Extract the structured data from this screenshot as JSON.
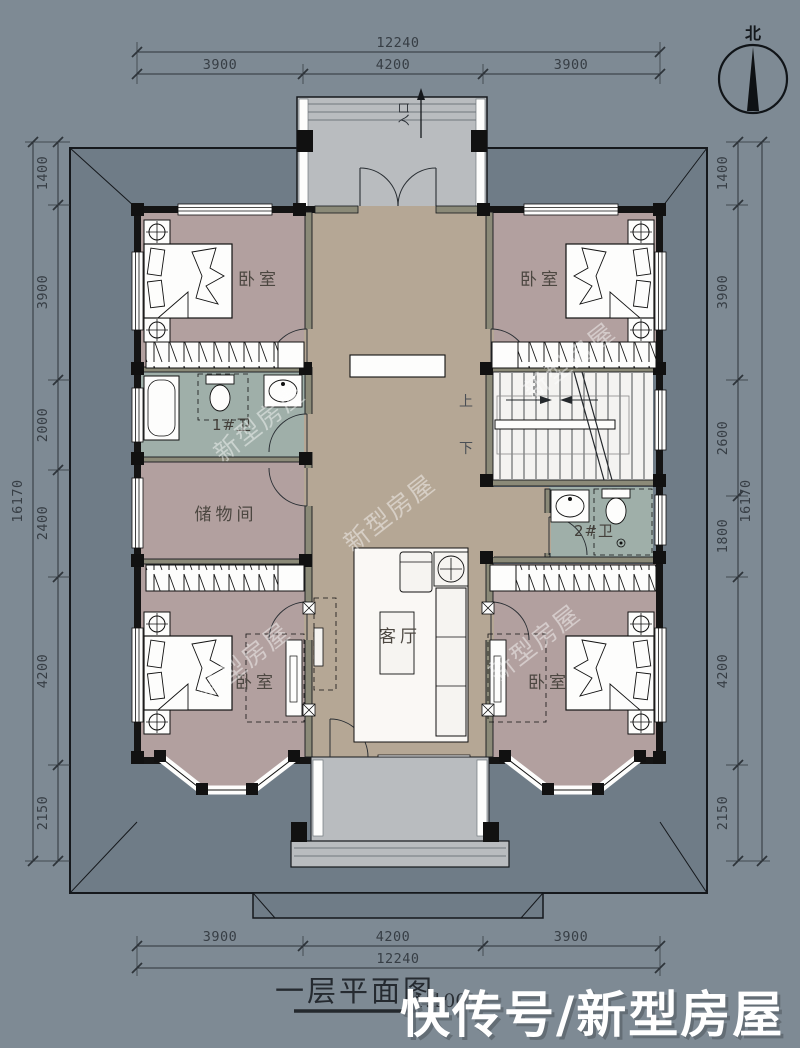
{
  "meta": {
    "title": "一层平面图",
    "scale": "1:100"
  },
  "watermark": {
    "brand": "快传号/新型房屋",
    "tiled": "新型房屋"
  },
  "compass": {
    "north": "北"
  },
  "entry": {
    "label": "入口"
  },
  "stairs": {
    "up": "上",
    "down": "下"
  },
  "rooms": {
    "bedroom_tl": "卧室",
    "bedroom_tr": "卧室",
    "bath1": "1#卫",
    "storage": "储物间",
    "living": "客厅",
    "bath2": "2#卫",
    "bedroom_bl": "卧室",
    "bedroom_br": "卧室"
  },
  "dimensions": {
    "top": {
      "total": "12240",
      "segments": [
        "3900",
        "4200",
        "3900"
      ]
    },
    "bottom": {
      "total": "12240",
      "segments": [
        "3900",
        "4200",
        "3900"
      ]
    },
    "left": {
      "total": "16170",
      "segments": [
        "1400",
        "3900",
        "2000",
        "2400",
        "4200",
        "2150"
      ]
    },
    "right": {
      "total": "16170",
      "segments": [
        "1400",
        "3900",
        "2600",
        "1800",
        "4200",
        "2150"
      ]
    }
  },
  "colors": {
    "background": "#7e8a94",
    "roof": "#6f7c87",
    "bedroom_floor": "#b2a09f",
    "hall_floor": "#b5a795",
    "bath_floor": "#9fafa9",
    "porch_floor": "#b9bcbf",
    "wall": "#141414",
    "partition": "#8b8a78"
  }
}
